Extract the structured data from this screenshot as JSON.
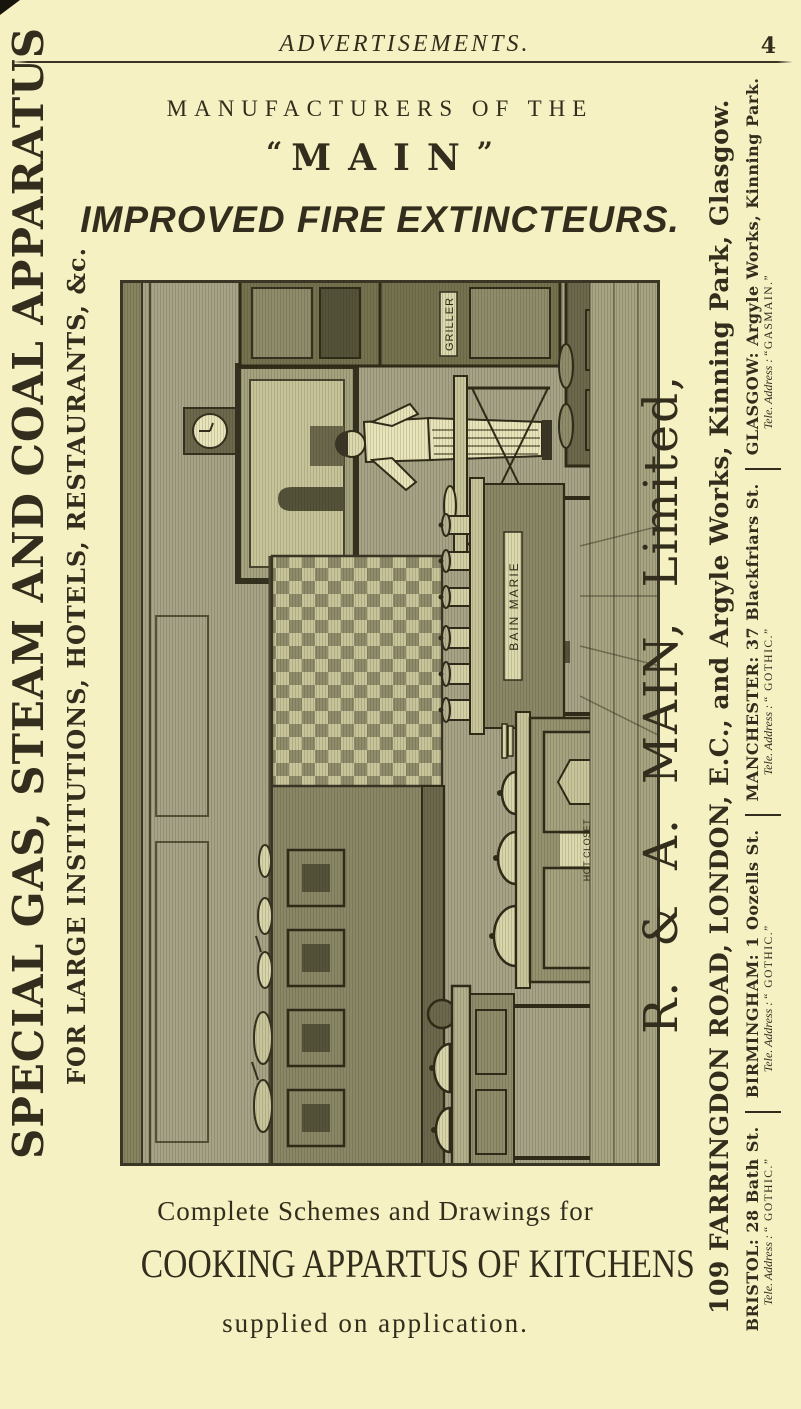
{
  "page": {
    "header": "ADVERTISEMENTS.",
    "page_number": "4"
  },
  "left_margin": {
    "line1": "SPECIAL GAS, STEAM AND COAL APPARATUS",
    "line2": "FOR LARGE INSTITUTIONS, HOTELS, RESTAURANTS, &c."
  },
  "masthead": {
    "intro": "MANUFACTURERS OF THE",
    "open_quote": "“",
    "brand": "MAIN",
    "close_quote": "”",
    "product": "IMPROVED FIRE EXTINCTEURS."
  },
  "illustration": {
    "labels": {
      "griller": "GRILLER",
      "bain_marie": "BAIN MARIE",
      "hot_closet": "HOT CLOSET"
    }
  },
  "right_margin": {
    "company": "R. & A. MAIN, Limited,",
    "addresses": "109 FARRINGDON ROAD, LONDON, E.C., and Argyle Works, Kinning Park, Glasgow.",
    "branches": [
      {
        "main": "BRISTOL: 28 Bath St.",
        "tele_label": "Tele. Address :",
        "tele_value": "“ GOTHIC.”"
      },
      {
        "main": "BIRMINGHAM: 1 Oozells St.",
        "tele_label": "Tele. Address :",
        "tele_value": "“ GOTHIC.”"
      },
      {
        "main": "MANCHESTER: 37 Blackfriars St.",
        "tele_label": "Tele. Address :",
        "tele_value": "“ GOTHIC.”"
      },
      {
        "main": "GLASGOW: Argyle Works, Kinning Park.",
        "tele_label": "Tele. Address :",
        "tele_value": "“GASMAIN.”"
      }
    ]
  },
  "footer": {
    "line1": "Complete Schemes and Drawings for",
    "line2": "COOKING APPARTUS OF KITCHENS",
    "line3": "supplied on application."
  },
  "colors": {
    "paper": "#f5f1c2",
    "ink": "#322d1c",
    "engraving_base": "#b5b293",
    "engraving_mid": "#8f8c6b",
    "engraving_dark": "#4a4730",
    "engraving_light": "#d9d5aa"
  }
}
